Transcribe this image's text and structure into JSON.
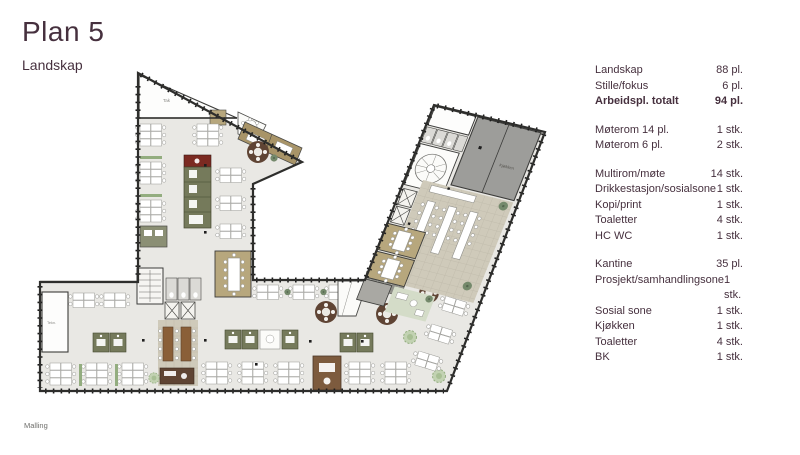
{
  "header": {
    "title": "Plan 5",
    "subtitle": "Landskap"
  },
  "footer": {
    "brand": "Malling"
  },
  "colors": {
    "accent_text": "#46303e",
    "floor": "#e9e8e4",
    "meeting_tan": "#b7a77d",
    "booth_olive": "#757a5b",
    "kitchen_gray": "#9d9d9a",
    "wood_brown": "#8a5f38",
    "wall": "#2e2e2c"
  },
  "plan": {
    "labels": {
      "terrace": "Tak",
      "technical": "Tekn.",
      "kitchen": "Kjøkken"
    }
  },
  "stats": {
    "rows": [
      {
        "label": "Landskap",
        "value": "88 pl."
      },
      {
        "label": "Stille/fokus",
        "value": "6 pl."
      },
      {
        "label": "Arbeidspl. totalt",
        "value": "94 pl.",
        "bold": true
      },
      {
        "label": "Møterom 14 pl.",
        "value": "1 stk.",
        "gap": true
      },
      {
        "label": "Møterom 6 pl.",
        "value": "2 stk."
      },
      {
        "label": "Multirom/møte",
        "value": "14 stk.",
        "gap": true
      },
      {
        "label": "Drikkestasjon/sosialsone",
        "value": "1 stk."
      },
      {
        "label": "Kopi/print",
        "value": "1 stk."
      },
      {
        "label": "Toaletter",
        "value": "4 stk."
      },
      {
        "label": "HC WC",
        "value": "1 stk."
      },
      {
        "label": "Kantine",
        "value": "35 pl.",
        "gap": true
      },
      {
        "label": "Prosjekt/samhandlingsone",
        "value": "1 stk."
      },
      {
        "label": "Sosial sone",
        "value": "1 stk."
      },
      {
        "label": "Kjøkken",
        "value": "1 stk."
      },
      {
        "label": "Toaletter",
        "value": "4 stk."
      },
      {
        "label": "BK",
        "value": "1 stk."
      }
    ]
  }
}
